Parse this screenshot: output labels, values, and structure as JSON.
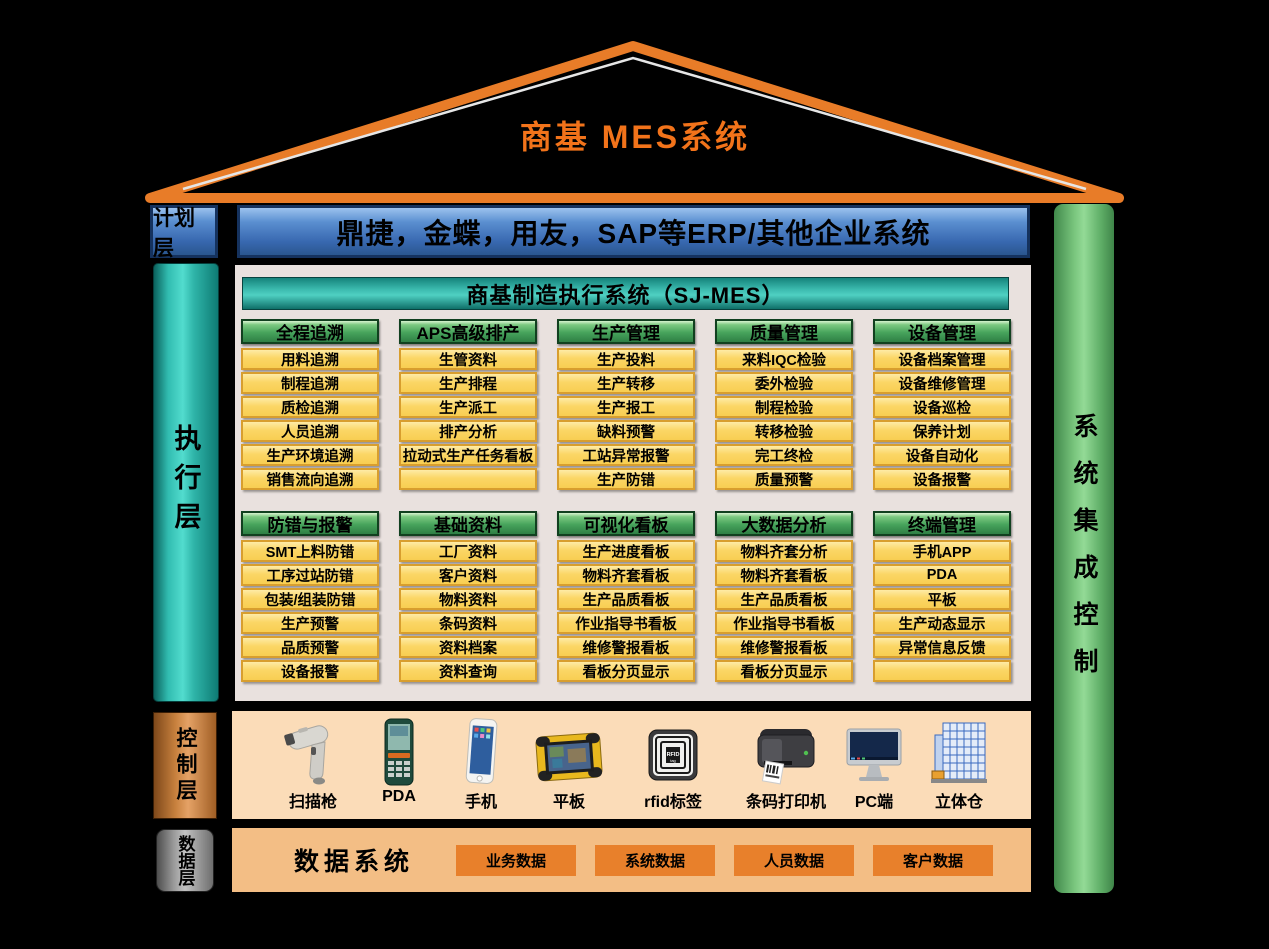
{
  "title": "商基  MES系统",
  "layers": {
    "plan": {
      "label": "计划层",
      "erp_text": "鼎捷，金蝶，用友，SAP等ERP/其他企业系统"
    },
    "execution": {
      "label": "执行层"
    },
    "control": {
      "label": "控制层"
    },
    "data": {
      "label": "数据层",
      "title": "数据系统",
      "buttons": [
        "业务数据",
        "系统数据",
        "人员数据",
        "客户数据"
      ]
    }
  },
  "right_bar": {
    "label": "系统集成控制"
  },
  "mes_panel": {
    "header": "商基制造执行系统（SJ-MES）",
    "module_rows": [
      [
        {
          "header": "全程追溯",
          "items": [
            "用料追溯",
            "制程追溯",
            "质检追溯",
            "人员追溯",
            "生产环境追溯",
            "销售流向追溯"
          ]
        },
        {
          "header": "APS高级排产",
          "items": [
            "生管资料",
            "生产排程",
            "生产派工",
            "排产分析",
            "拉动式生产任务看板",
            ""
          ]
        },
        {
          "header": "生产管理",
          "items": [
            "生产投料",
            "生产转移",
            "生产报工",
            "缺料预警",
            "工站异常报警",
            "生产防错"
          ]
        },
        {
          "header": "质量管理",
          "items": [
            "来料IQC检验",
            "委外检验",
            "制程检验",
            "转移检验",
            "完工终检",
            "质量预警"
          ]
        },
        {
          "header": "设备管理",
          "items": [
            "设备档案管理",
            "设备维修管理",
            "设备巡检",
            "保养计划",
            "设备自动化",
            "设备报警"
          ]
        }
      ],
      [
        {
          "header": "防错与报警",
          "items": [
            "SMT上料防错",
            "工序过站防错",
            "包装/组装防错",
            "生产预警",
            "品质预警",
            "设备报警"
          ]
        },
        {
          "header": "基础资料",
          "items": [
            "工厂资料",
            "客户资料",
            "物料资料",
            "条码资料",
            "资料档案",
            "资料查询"
          ]
        },
        {
          "header": "可视化看板",
          "items": [
            "生产进度看板",
            "物料齐套看板",
            "生产品质看板",
            "作业指导书看板",
            "维修警报看板",
            "看板分页显示"
          ]
        },
        {
          "header": "大数据分析",
          "items": [
            "物料齐套分析",
            "物料齐套看板",
            "生产品质看板",
            "作业指导书看板",
            "维修警报看板",
            "看板分页显示"
          ]
        },
        {
          "header": "终端管理",
          "items": [
            "手机APP",
            "PDA",
            "平板",
            "生产动态显示",
            "异常信息反馈",
            ""
          ]
        }
      ]
    ]
  },
  "devices": [
    {
      "label": "扫描枪",
      "icon": "scanner"
    },
    {
      "label": "PDA",
      "icon": "pda"
    },
    {
      "label": "手机",
      "icon": "phone"
    },
    {
      "label": "平板",
      "icon": "tablet"
    },
    {
      "label": "rfid标签",
      "icon": "rfid"
    },
    {
      "label": "条码打印机",
      "icon": "barcode-printer"
    },
    {
      "label": "PC端",
      "icon": "pc"
    },
    {
      "label": "立体仓",
      "icon": "warehouse"
    }
  ],
  "colors": {
    "roof_orange": "#F2731A",
    "plan_blue": "#3868B0",
    "exec_teal": "#31BCB0",
    "module_green": "#47A45C",
    "module_yellow": "#FBD666",
    "control_copper": "#C8813E",
    "control_bg": "#FBDCB8",
    "data_bg": "#F3BE85",
    "data_chip": "#E8802B",
    "integration_green": "#7BC77F",
    "panel_bg": "#E9E1DE"
  }
}
